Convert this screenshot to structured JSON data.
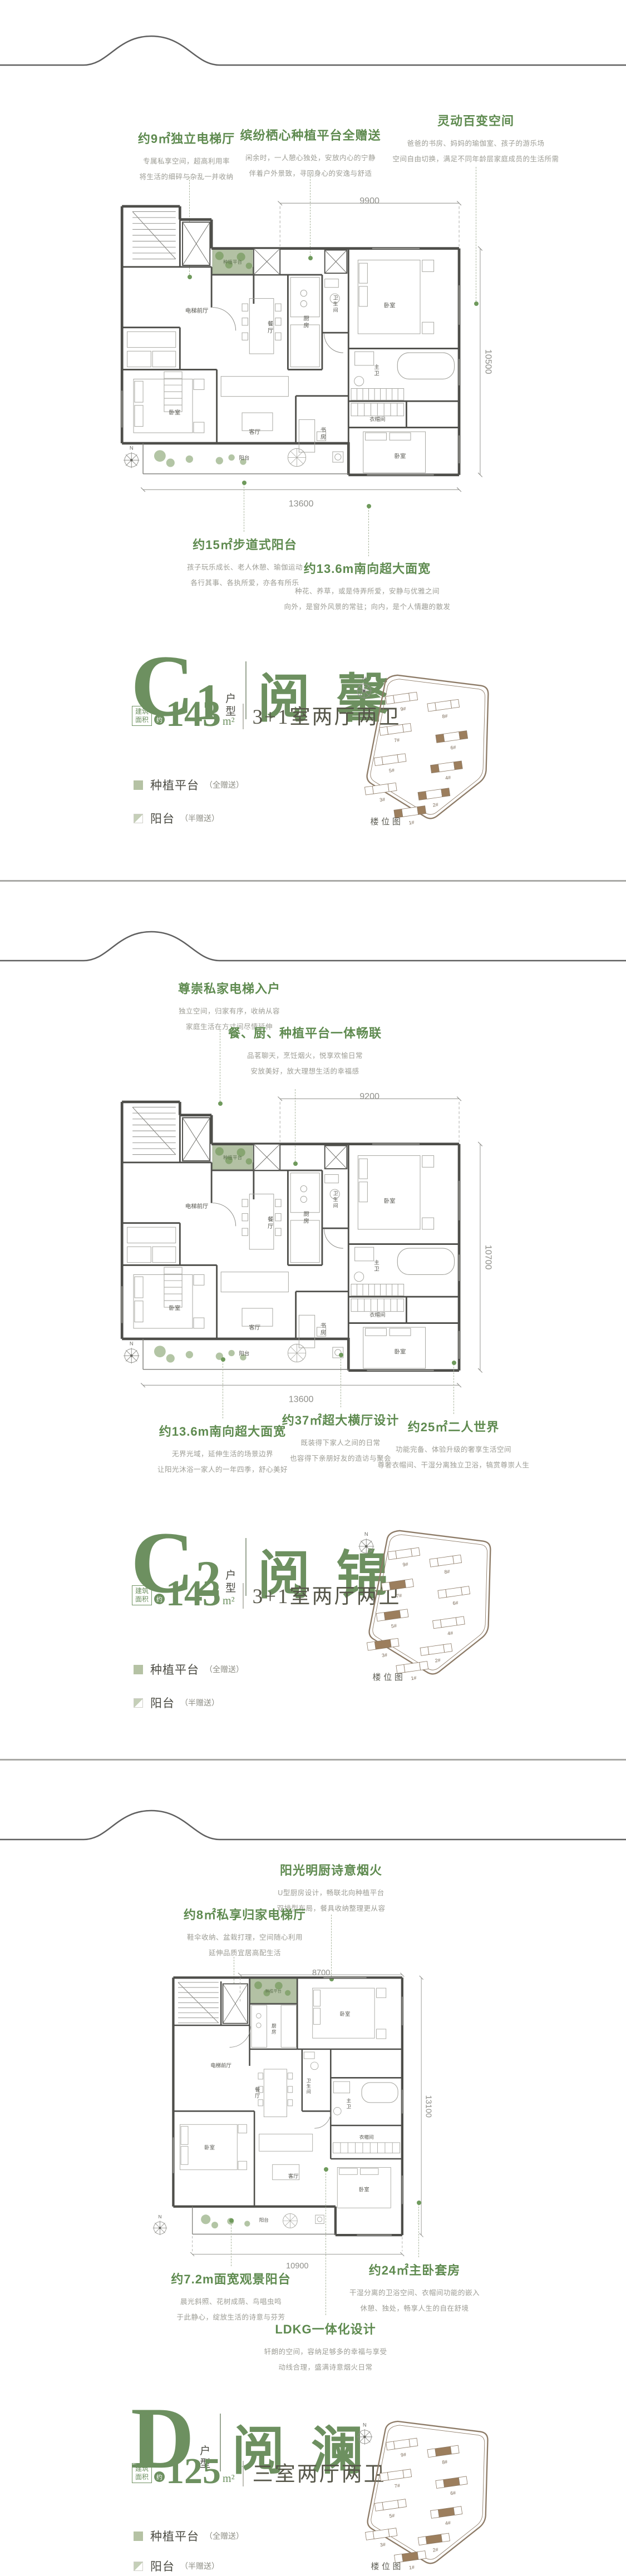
{
  "sections": [
    {
      "unit": {
        "letter": "C",
        "number": "1",
        "type_label": "户型",
        "name": "阅 馨",
        "area_box_line1": "建筑",
        "area_box_line2": "面积",
        "area_approx": "约",
        "area": "143",
        "area_unit": "m²",
        "layout": "3+1室两厅两卫"
      },
      "annotations_top": [
        {
          "title": "约9㎡独立电梯厅",
          "line1": "专属私享空间，超高利用率",
          "line2": "将生活的细碎与杂乱一并收纳"
        },
        {
          "title": "缤纷栖心种植平台全赠送",
          "line1": "闲余时，一人憩心独处，安放内心的宁静",
          "line2": "伴着户外景致，寻回身心的安逸与舒适"
        },
        {
          "title": "灵动百变空间",
          "line1": "爸爸的书房、妈妈的瑜伽室、孩子的游乐场",
          "line2": "空间自由切换，满足不同年龄层家庭成员的生活所需"
        }
      ],
      "annotations_bottom": [
        {
          "title": "约15㎡步道式阳台",
          "line1": "孩子玩乐成长、老人休憩、瑜伽运动",
          "line2": "各行其事、各执所爱，亦各有所乐"
        },
        {
          "title": "约13.6m南向超大面宽",
          "line1": "种花、养草，或是侍弄所爱，安静与优雅之间",
          "line2": "向外，是窗外风景的常驻；向内，是个人情趣的散发"
        }
      ],
      "plan": {
        "compass": "N",
        "dims": {
          "top": "9900",
          "right": "10500",
          "bottom": "13600"
        },
        "rooms": {
          "hall": "电梯前厅",
          "platform": "种植平台",
          "dining": "餐厅",
          "kitchen": "厨房",
          "bath": "卫生间",
          "bedroom_a": "卧室",
          "master_bath": "主卫",
          "closet": "衣帽间",
          "study": "书房",
          "living": "客厅",
          "bedroom_b": "卧室",
          "bedroom_c": "卧室",
          "balcony": "阳台"
        }
      },
      "legend": [
        {
          "swatch": "full",
          "label": "种植平台",
          "note": "（全赠送）"
        },
        {
          "swatch": "half",
          "label": "阳台",
          "note": "（半赠送）"
        }
      ],
      "site_plan": {
        "caption": "楼位图",
        "compass": "N",
        "highlight_mode": "ends",
        "highlighted": [
          "6#",
          "4#",
          "2#",
          "1#"
        ],
        "buildings": [
          {
            "label": "9#"
          },
          {
            "label": "8#"
          },
          {
            "label": "7#"
          },
          {
            "label": "6#"
          },
          {
            "label": "5#"
          },
          {
            "label": "4#"
          },
          {
            "label": "3#"
          },
          {
            "label": "2#"
          },
          {
            "label": "1#"
          }
        ]
      }
    },
    {
      "unit": {
        "letter": "C",
        "number": "2",
        "type_label": "户型",
        "name": "阅 锦",
        "area_box_line1": "建筑",
        "area_box_line2": "面积",
        "area_approx": "约",
        "area": "143",
        "area_unit": "m²",
        "layout": "3+1室两厅两卫"
      },
      "annotations_top": [
        {
          "title": "尊崇私家电梯入户",
          "line1": "独立空间，归家有序，收纳从容",
          "line2": "家庭生活在方寸间尽情延伸"
        },
        {
          "title": "餐、厨、种植平台一体畅联",
          "line1": "品茗聊天，烹饪烟火，悦享欢愉日常",
          "line2": "安放美好，放大理想生活的幸福感"
        }
      ],
      "annotations_bottom": [
        {
          "title": "约13.6m南向超大面宽",
          "line1": "无界光域，延伸生活的场景边界",
          "line2": "让阳光沐浴一家人的一年四季，舒心美好"
        },
        {
          "title": "约37㎡超大横厅设计",
          "line1": "既装得下家人之间的日常",
          "line2": "也容得下亲朋好友的造访与聚会"
        },
        {
          "title": "约25㎡二人世界",
          "line1": "功能完备、体验升级的奢享生活空间",
          "line2": "尊奢衣帽间、干湿分离独立卫浴，犒赏尊崇人生"
        }
      ],
      "plan": {
        "compass": "N",
        "dims": {
          "top": "9200",
          "right": "10700",
          "bottom": "13600"
        },
        "rooms": {
          "hall": "电梯前厅",
          "platform": "种植平台",
          "dining": "餐厅",
          "kitchen": "厨房",
          "bath": "卫生间",
          "bedroom_a": "卧室",
          "master_bath": "主卫",
          "closet": "衣帽间",
          "study": "书房",
          "living": "客厅",
          "bedroom_b": "卧室",
          "bedroom_c": "卧室",
          "balcony": "阳台"
        }
      },
      "legend": [
        {
          "swatch": "full",
          "label": "种植平台",
          "note": "（全赠送）"
        },
        {
          "swatch": "half",
          "label": "阳台",
          "note": "（半赠送）"
        }
      ],
      "site_plan": {
        "caption": "楼位图",
        "compass": "N",
        "highlight_mode": "mid",
        "highlighted": [
          "7#",
          "5#",
          "3#"
        ],
        "buildings": [
          {
            "label": "9#"
          },
          {
            "label": "8#"
          },
          {
            "label": "7#"
          },
          {
            "label": "6#"
          },
          {
            "label": "5#"
          },
          {
            "label": "4#"
          },
          {
            "label": "3#"
          },
          {
            "label": "2#"
          },
          {
            "label": "1#"
          }
        ]
      }
    },
    {
      "unit": {
        "letter": "D",
        "number": "",
        "type_label": "户型",
        "name": "阅 澜",
        "area_box_line1": "建筑",
        "area_box_line2": "面积",
        "area_approx": "约",
        "area": "125",
        "area_unit": "m²",
        "layout": "三室两厅两卫"
      },
      "annotations_top": [
        {
          "title": "阳光明厨诗意烟火",
          "line1": "U型厨房设计，畅联北向种植平台",
          "line2": "双排型布局，餐具收纳整理更从容"
        },
        {
          "title": "约8㎡私享归家电梯厅",
          "line1": "鞋伞收纳、盆栽打理，空间随心利用",
          "line2": "延伸品质宜居高配生活"
        }
      ],
      "annotations_bottom": [
        {
          "title": "约7.2m面宽观景阳台",
          "line1": "晨光斜照、花树成荫、鸟唱虫鸣",
          "line2": "于此静心，绽放生活的诗意与芬芳"
        },
        {
          "title": "约24㎡主卧套房",
          "line1": "干湿分离的卫浴空间、衣帽间功能的嵌入",
          "line2": "休憩、独处，畅享人生的自在舒境"
        },
        {
          "title": "LDKG一体化设计",
          "line1": "轩朗的空间，容纳足够多的幸福与享受",
          "line2": "动线合理，盛满诗意烟火日常"
        }
      ],
      "plan": {
        "compass": "N",
        "dims": {
          "top": "8700",
          "right": "13100",
          "bottom": "10900"
        },
        "rooms": {
          "hall": "电梯前厅",
          "platform": "种植平台",
          "dining": "餐厅",
          "kitchen": "厨房",
          "bath": "卫生间",
          "bedroom_a": "卧室",
          "master_bath": "主卫",
          "closet": "衣帽间",
          "living": "客厅",
          "bedroom_b": "卧室",
          "bedroom_c": "卧室",
          "balcony": "阳台"
        }
      },
      "legend": [
        {
          "swatch": "full",
          "label": "种植平台",
          "note": "（全赠送）"
        },
        {
          "swatch": "half",
          "label": "阳台",
          "note": "（半赠送）"
        }
      ],
      "site_plan": {
        "caption": "楼位图",
        "compass": "N",
        "highlight_mode": "mid",
        "highlighted": [
          "8#",
          "6#",
          "4#",
          "2#",
          "1#"
        ],
        "buildings": [
          {
            "label": "9#"
          },
          {
            "label": "8#"
          },
          {
            "label": "7#"
          },
          {
            "label": "6#"
          },
          {
            "label": "5#"
          },
          {
            "label": "4#"
          },
          {
            "label": "3#"
          },
          {
            "label": "2#"
          },
          {
            "label": "1#"
          }
        ]
      }
    }
  ]
}
